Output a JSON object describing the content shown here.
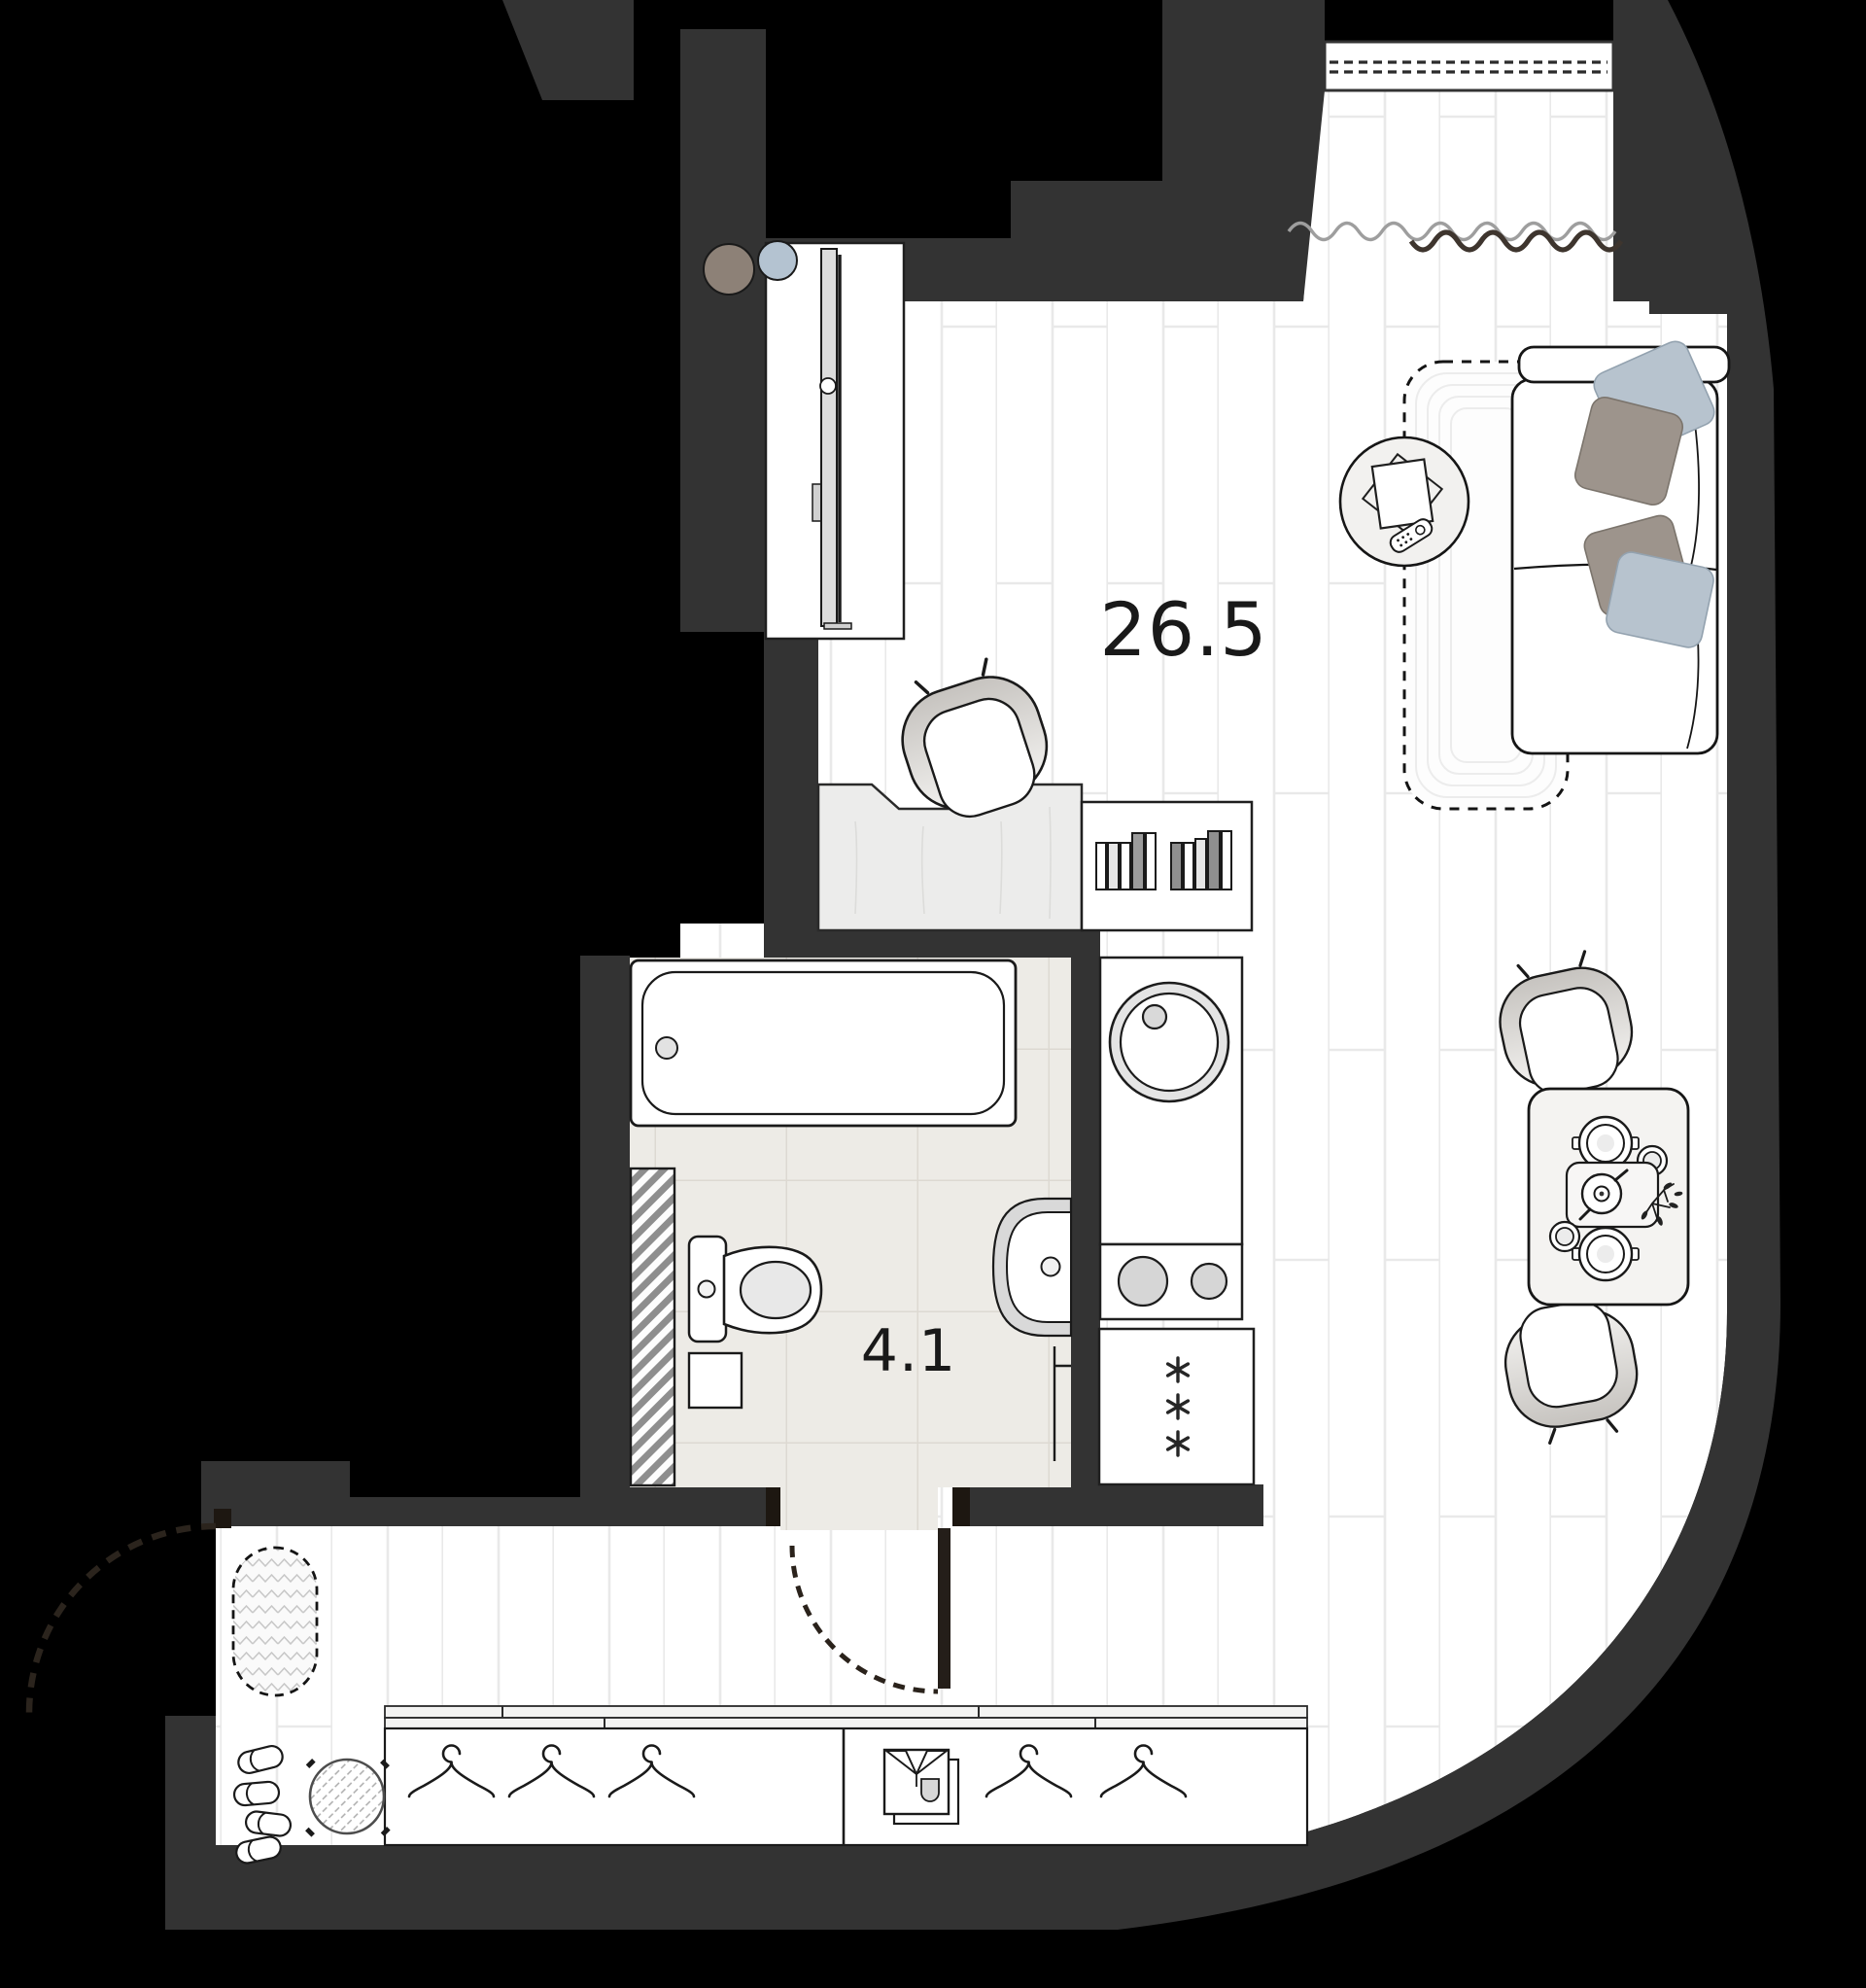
{
  "page": {
    "type": "apartment-floor-plan",
    "background": "#000000"
  },
  "rooms": {
    "living": {
      "name": "living-room-with-kitchen",
      "label": "26.5"
    },
    "bathroom": {
      "name": "bathroom",
      "label": "4.1"
    }
  },
  "palette": {
    "wall": "#333333",
    "door": "#231c15",
    "floor": "#ffffff",
    "floor_seam": "#e9e9e9",
    "bath_tile": "#edebe6",
    "pillow_blue": "#b7c3ce",
    "pillow_taupe": "#9d948c",
    "decor_circle_brown": "#8d8177",
    "decor_circle_blue": "#b4c3d1",
    "burner_gray": "#d6d6d6"
  },
  "icons": {
    "hanger": "clothes-hanger-icon",
    "shirt": "folded-shirt-icon",
    "snowflake": "fridge-snowflake-icon"
  },
  "furniture": [
    "sofa",
    "pillows",
    "area-rug",
    "coffee-table",
    "tv-remote",
    "tv",
    "tv-cabinet",
    "desk",
    "desk-chair",
    "bookshelf",
    "bathtub",
    "toilet",
    "washer",
    "bathroom-sink",
    "ventilation-shaft",
    "kitchen-counter",
    "kitchen-sink",
    "cooktop",
    "fridge",
    "dining-table",
    "dining-chair",
    "teapot-tray",
    "plant",
    "wardrobe",
    "hangers",
    "pouf",
    "slippers",
    "entry-rug",
    "balcony-window",
    "curtain",
    "door-swing"
  ]
}
